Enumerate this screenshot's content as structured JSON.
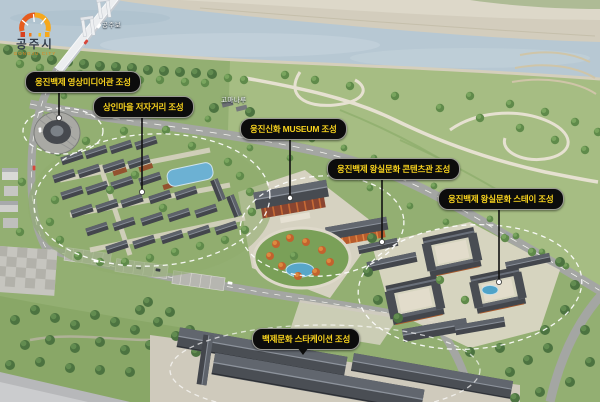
{
  "logo": {
    "city_name": "공주시",
    "city_name_en": "GONGJU CITY",
    "arch_icon": "gongju-arch-gate"
  },
  "map_texts": {
    "weir": "공주보",
    "gomanaru": "고마나루"
  },
  "callouts": [
    {
      "id": "media-hall",
      "label": "웅진백제 영상미디어관 조성"
    },
    {
      "id": "market-street",
      "label": "상인마을 저자거리 조성"
    },
    {
      "id": "museum",
      "label": "웅진신화 MUSEUM 조성"
    },
    {
      "id": "royal-contents-hall",
      "label": "웅진백제 왕실문화 콘텐츠관 조성"
    },
    {
      "id": "royal-stay",
      "label": "웅진백제 왕실문화 스테이 조성"
    },
    {
      "id": "staycation",
      "label": "백제문화 스타케이션 조성"
    }
  ],
  "colors": {
    "label_bg": "#0c0c0c",
    "label_text": "#f7d21e",
    "water": "#b7c8d3",
    "logo_orange": "#e8821a",
    "dashed_zone": "#ffffff"
  }
}
